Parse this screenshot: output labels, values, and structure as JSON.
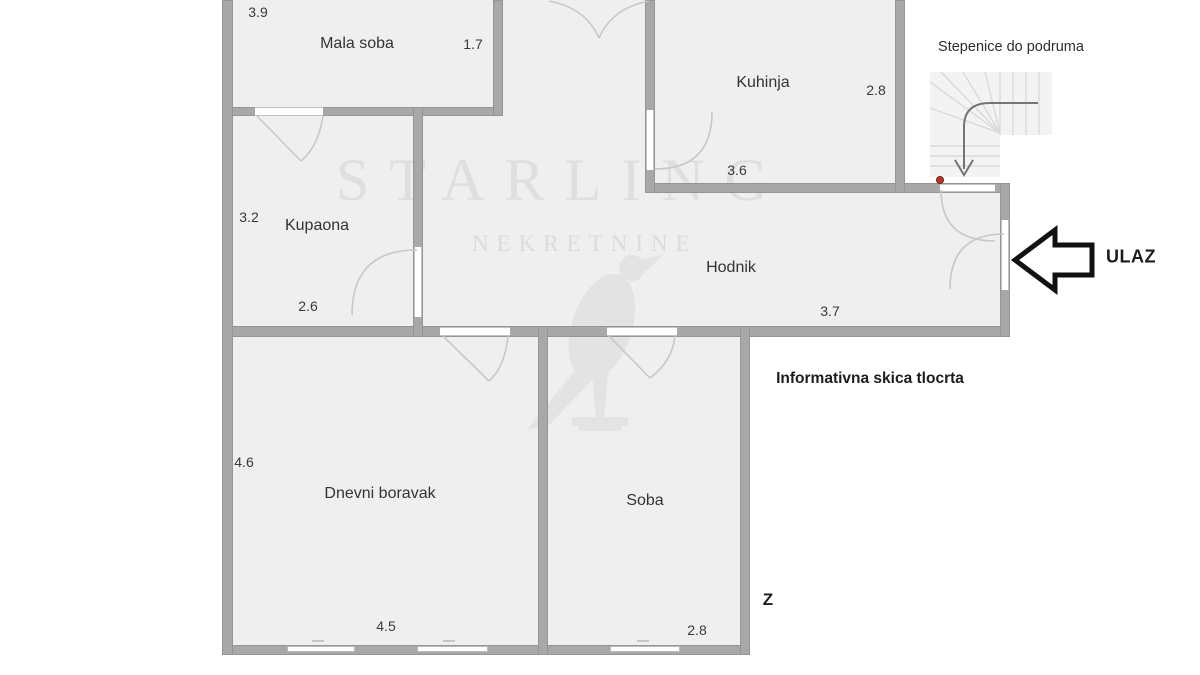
{
  "rooms": {
    "mala_soba": {
      "label": "Mala soba",
      "dim_w": "3.9",
      "dim_h": "1.7"
    },
    "kuhinja": {
      "label": "Kuhinja",
      "dim_h": "2.8",
      "dim_w": "3.6"
    },
    "kupaona": {
      "label": "Kupaona",
      "dim_h": "3.2",
      "dim_w": "2.6"
    },
    "hodnik": {
      "label": "Hodnik",
      "dim_w": "3.7"
    },
    "dnevni_boravak": {
      "label": "Dnevni boravak",
      "dim_h": "4.6",
      "dim_w": "4.5"
    },
    "soba": {
      "label": "Soba",
      "dim_w": "2.8"
    }
  },
  "annotations": {
    "stairs_label": "Stepenice do podruma",
    "entrance_label": "ULAZ",
    "note": "Informativna skica tlocrta",
    "compass_west": "Z"
  },
  "watermark": {
    "brand": "STARLING",
    "subtitle": "NEKRETNINE"
  },
  "colors": {
    "wall": "#a8a8a8",
    "room_fill": "#efefef",
    "door_arc": "#c8c8c8",
    "stairs_tread": "#dadada",
    "entrance_marker_red": "#b5372a",
    "arrow_outline": "#111111"
  }
}
